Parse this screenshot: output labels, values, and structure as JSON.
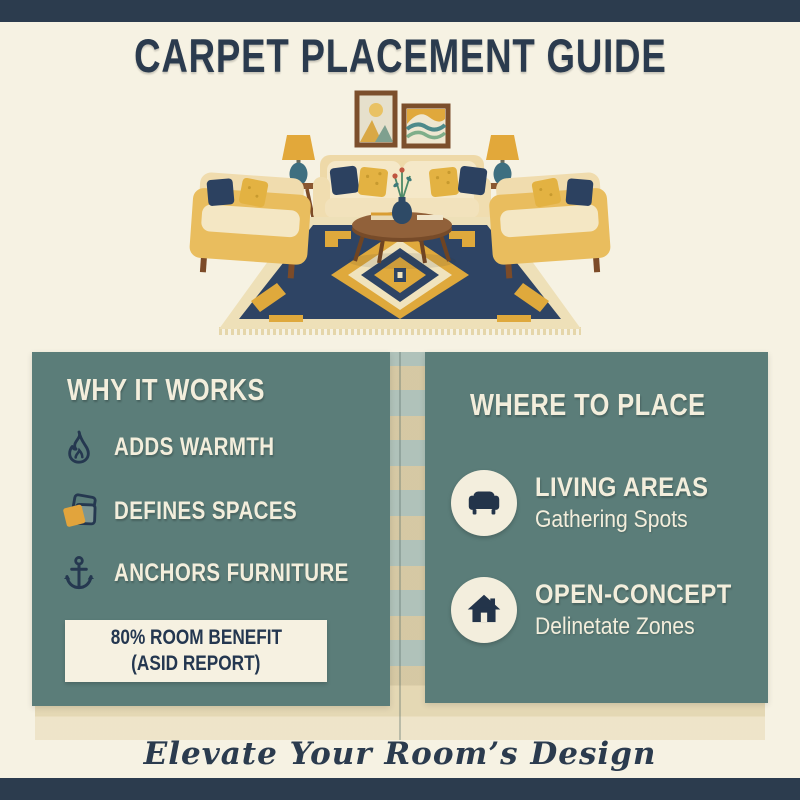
{
  "colors": {
    "navy": "#2c3c4e",
    "panel_teal": "#5b7d79",
    "cream_background": "#f6f2e3",
    "text_cream": "#f3eedc",
    "gold_accent": "#e2a43c",
    "stat_box_background": "#f6f1e1"
  },
  "header": {
    "title": "CARPET PLACEMENT GUIDE"
  },
  "left_panel": {
    "heading": "WHY IT WORKS",
    "items": [
      {
        "icon": "flame-icon",
        "label": "ADDS WARMTH"
      },
      {
        "icon": "layers-icon",
        "label": "DEFINES SPACES"
      },
      {
        "icon": "anchor-icon",
        "label": "ANCHORS FURNITURE"
      }
    ],
    "stat_box": {
      "line1": "80% ROOM BENEFIT",
      "line2": "(ASID REPORT)"
    }
  },
  "right_panel": {
    "heading": "WHERE TO PLACE",
    "items": [
      {
        "icon": "sofa-icon",
        "title": "LIVING AREAS",
        "subtitle": "Gathering Spots"
      },
      {
        "icon": "house-icon",
        "title": "OPEN-CONCEPT",
        "subtitle": "Delinetate Zones"
      }
    ]
  },
  "footer": {
    "tagline": "Elevate Your Room’s Design"
  }
}
